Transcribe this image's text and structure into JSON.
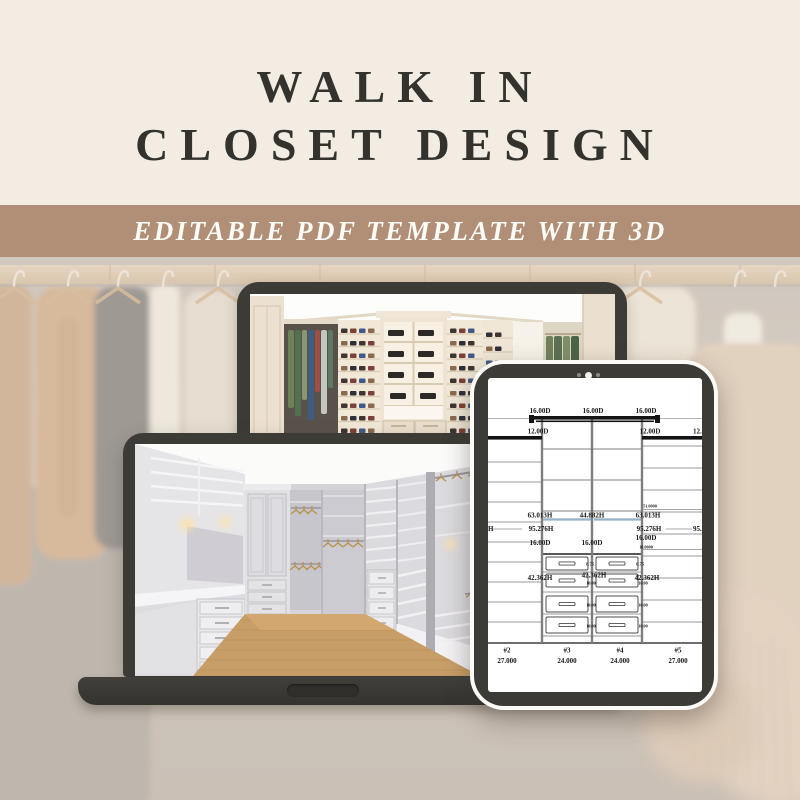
{
  "page": {
    "title_line1": "WALK IN",
    "title_line2": "CLOSET DESIGN",
    "banner_text": "EDITABLE PDF TEMPLATE WITH 3D"
  },
  "colors": {
    "page_bg": "#f2ece3",
    "banner_bg": "#b18e76",
    "title_text": "#33322d",
    "device_bezel": "#3c3b36",
    "draw_line": "#9a9a9a",
    "draw_text": "#181818",
    "rod_blue": "#93b1c7"
  },
  "tablet": {
    "drawing": {
      "canvas": {
        "w": 214,
        "h": 314
      },
      "bars": [
        [
          44,
          38,
          126,
          3.6
        ],
        [
          41,
          37,
          5,
          8
        ],
        [
          167,
          37,
          5,
          8
        ],
        [
          48,
          42.5,
          118,
          1.6
        ],
        [
          0,
          58,
          54,
          3.6
        ],
        [
          154,
          58,
          60,
          3.6
        ]
      ],
      "full_lines": [
        [
          0,
          40.5,
          214,
          40.5
        ]
      ],
      "verticals": [
        [
          54,
          41,
          265
        ],
        [
          104,
          41,
          265
        ],
        [
          154,
          41,
          265
        ]
      ],
      "shelves_left_y": [
        84,
        104,
        124,
        144,
        164,
        184,
        204,
        224,
        244
      ],
      "shelves_right_y": [
        68,
        90,
        112,
        134,
        156,
        178,
        200,
        222,
        244
      ],
      "shelves_center_y": [
        71,
        102,
        133
      ],
      "drawer_sep_y": [
        194,
        214,
        236,
        258
      ],
      "drawer_top_y": 176,
      "baseline_y": 265,
      "rods": [
        [
          55,
          141.5,
          103
        ],
        [
          106,
          141.5,
          153
        ]
      ],
      "leaders": [
        [
          4,
          151,
          34
        ],
        [
          178,
          151,
          204
        ],
        [
          154,
          131.5,
          214
        ],
        [
          154,
          171.5,
          214
        ]
      ],
      "drawer_cols_x": [
        58,
        108
      ],
      "drawer_col_w": 42,
      "drawer_rows": [
        [
          179,
          13
        ],
        [
          196,
          13
        ],
        [
          218,
          16
        ],
        [
          239,
          16
        ]
      ],
      "labels": [
        {
          "t": "16.00D",
          "x": 52,
          "y": 33,
          "s": 7
        },
        {
          "t": "16.00D",
          "x": 105,
          "y": 33,
          "s": 7
        },
        {
          "t": "16.00D",
          "x": 158,
          "y": 33,
          "s": 7
        },
        {
          "t": "12.00D",
          "x": 50,
          "y": 53.5,
          "s": 7
        },
        {
          "t": "12.00D",
          "x": 162,
          "y": 53.5,
          "s": 7
        },
        {
          "t": "12.0",
          "x": 205,
          "y": 53.5,
          "s": 7,
          "a": "s"
        },
        {
          "t": "51.0000",
          "x": 162,
          "y": 128,
          "s": 4.2
        },
        {
          "t": "63.013H",
          "x": 52,
          "y": 137.5,
          "s": 7
        },
        {
          "t": "44.882H",
          "x": 104,
          "y": 137.5,
          "s": 7
        },
        {
          "t": "63.013H",
          "x": 160,
          "y": 137.5,
          "s": 7
        },
        {
          "t": "H",
          "x": 0,
          "y": 151,
          "s": 7,
          "a": "s"
        },
        {
          "t": "95.276H",
          "x": 53,
          "y": 151,
          "s": 7
        },
        {
          "t": "95.276H",
          "x": 161,
          "y": 151,
          "s": 7
        },
        {
          "t": "95.2",
          "x": 205,
          "y": 151,
          "s": 7,
          "a": "s"
        },
        {
          "t": "16.00D",
          "x": 52,
          "y": 165,
          "s": 7
        },
        {
          "t": "16.00D",
          "x": 104,
          "y": 165,
          "s": 7
        },
        {
          "t": "16.00D",
          "x": 158,
          "y": 160,
          "s": 7
        },
        {
          "t": "18.0000",
          "x": 158,
          "y": 169,
          "s": 4.2
        },
        {
          "t": "8.75",
          "x": 102,
          "y": 186,
          "s": 4.5
        },
        {
          "t": "8.75",
          "x": 152,
          "y": 186,
          "s": 4.5
        },
        {
          "t": "42.362H",
          "x": 52,
          "y": 200,
          "s": 7
        },
        {
          "t": "42.362H",
          "x": 106,
          "y": 197.5,
          "s": 7
        },
        {
          "t": "42.362H",
          "x": 159,
          "y": 200,
          "s": 7
        },
        {
          "t": "10.00",
          "x": 103,
          "y": 205,
          "s": 4.2
        },
        {
          "t": "10.00",
          "x": 155,
          "y": 205,
          "s": 4.2
        },
        {
          "t": "10.00",
          "x": 103,
          "y": 227,
          "s": 4.2
        },
        {
          "t": "10.00",
          "x": 155,
          "y": 227,
          "s": 4.2
        },
        {
          "t": "10.00",
          "x": 103,
          "y": 248,
          "s": 4.2
        },
        {
          "t": "10.00",
          "x": 155,
          "y": 248,
          "s": 4.2
        }
      ],
      "sections": [
        {
          "num": "#2",
          "width": "27.000",
          "x": 19
        },
        {
          "num": "#3",
          "width": "24.000",
          "x": 79
        },
        {
          "num": "#4",
          "width": "24.000",
          "x": 132
        },
        {
          "num": "#5",
          "width": "27.000",
          "x": 190
        }
      ]
    }
  }
}
